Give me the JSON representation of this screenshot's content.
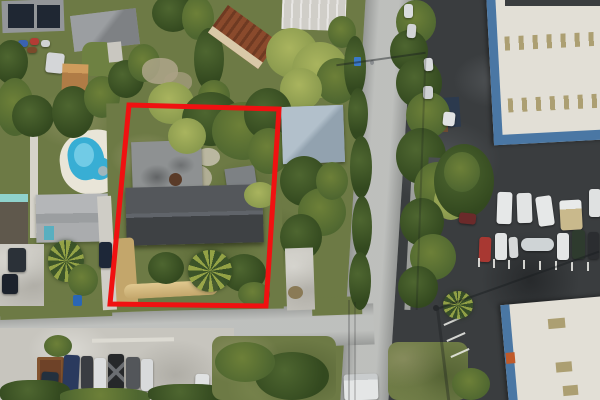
{
  "meta": {
    "type": "aerial-drone-photograph",
    "description": "Top-down aerial photo of a residential lot outlined in red; neighborhood with pool at left, vertical street at center-right, industrial white warehouses with blue trim at right, parked car rows at bottom-left and right.",
    "width": 600,
    "height": 400
  },
  "annotation": {
    "name": "property-boundary",
    "shape": "polygon",
    "points": "129,105 279,109 266,306 110,304",
    "color": "#f01111",
    "stroke_width": 5
  },
  "palette": {
    "annotation_red": "#f01111",
    "road_gray": "#b5b7b5",
    "asphalt_dark": "#3a3d3f",
    "concrete": "#c7c5be",
    "warehouse_white": "#e2dfd6",
    "warehouse_blue": "#4a77a4",
    "skylight_tan": "#ac9f72",
    "grass_mid": "#6d7a45",
    "grass_front": "#5a6d39",
    "tree_dark": "#33491f",
    "tree_mid": "#4e6630",
    "tree_light": "#8a9a4e",
    "sand_tan": "#c3a66b",
    "roof_charcoal": "#45484b",
    "roof_gray": "#939699",
    "roof_blue_gray": "#a2b1bd",
    "roof_rust": "#8a4a2c",
    "pool_blue": "#38aed4",
    "deck_white": "#e9e5d8",
    "teal": "#45b0c4",
    "solar_panel": "#1f2733"
  },
  "scene_inventory": {
    "outlined_lot": "grass lot with charcoal gable-roof house, small gray roof building, carport, sandy driveway and palm",
    "left_neighborhood": "kidney pool with white deck, gray hip-roof houses, teal-trimmed house, solar-panel roof, sheds",
    "right_industrial": "two white warehouse roofs with blue eaves and tan skylights, white van fleet, parking rows",
    "streets": "vertical street right of lot, horizontal street below lot, utility pole and wires",
    "vehicle_rows": "seven-car row bottom-left, mixed car/boat row right-center"
  }
}
